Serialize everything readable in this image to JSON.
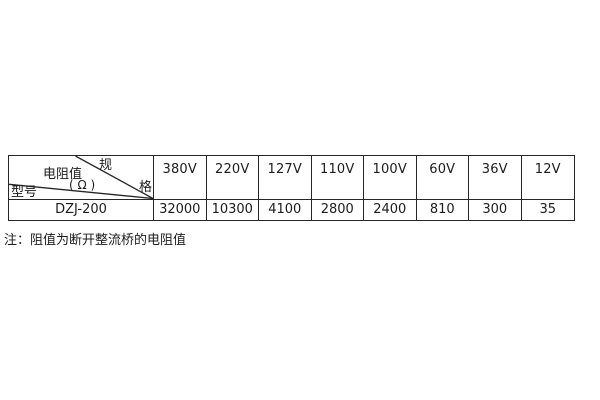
{
  "table": {
    "border_color": "#262626",
    "corner": {
      "spec_char_top": "规",
      "spec_char_bottom": "格",
      "resistance_label": "电阻值",
      "resistance_unit": "( Ω )",
      "model_label": "型号"
    },
    "columns": [
      "380V",
      "220V",
      "127V",
      "110V",
      "100V",
      "60V",
      "36V",
      "12V"
    ],
    "row": {
      "model": "DZJ-200",
      "values": [
        "32000",
        "10300",
        "4100",
        "2800",
        "2400",
        "810",
        "300",
        "35"
      ]
    }
  },
  "note": {
    "text": "注：阻值为断开整流桥的电阻值"
  }
}
